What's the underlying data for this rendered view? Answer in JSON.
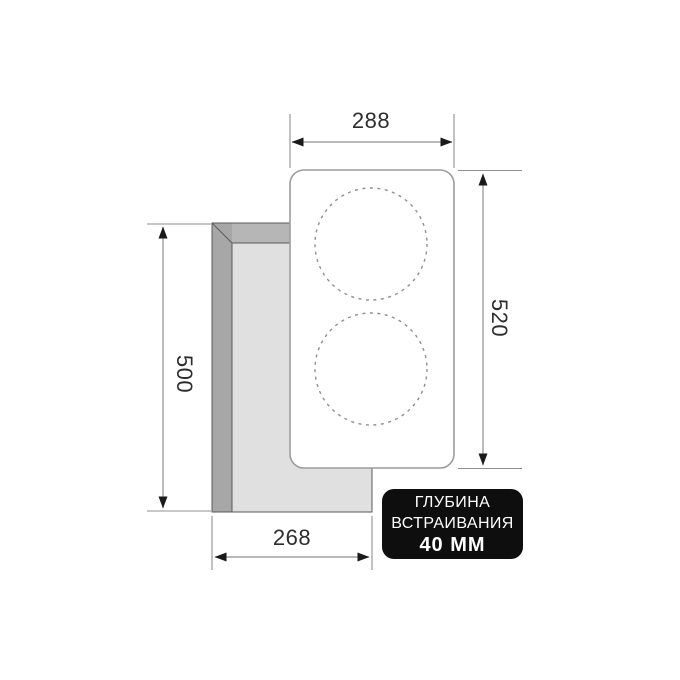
{
  "diagram": {
    "title": "cooktop installation dimensions",
    "dimensions": {
      "cooktop_width": "288",
      "cooktop_height": "520",
      "cutout_height": "500",
      "cutout_width": "268"
    },
    "badge": {
      "line1": "ГЛУБИНА",
      "line2": "ВСТРАИВАНИЯ",
      "line3": "40 ММ"
    },
    "colors": {
      "badge_bg": "#0e0e0e",
      "badge_text": "#ffffff",
      "label_text": "#2d2d2d",
      "line": "#8f8f8f",
      "arrow": "#1a1a1a",
      "counter_top_band": "#b6b6b6",
      "counter_left_band": "#a7a7a7",
      "counter_inner": "#e0e0e0",
      "counter_outline": "#5a5a5a",
      "cooktop_border": "#9c9c9c",
      "burner": "#8f8f8f"
    }
  }
}
